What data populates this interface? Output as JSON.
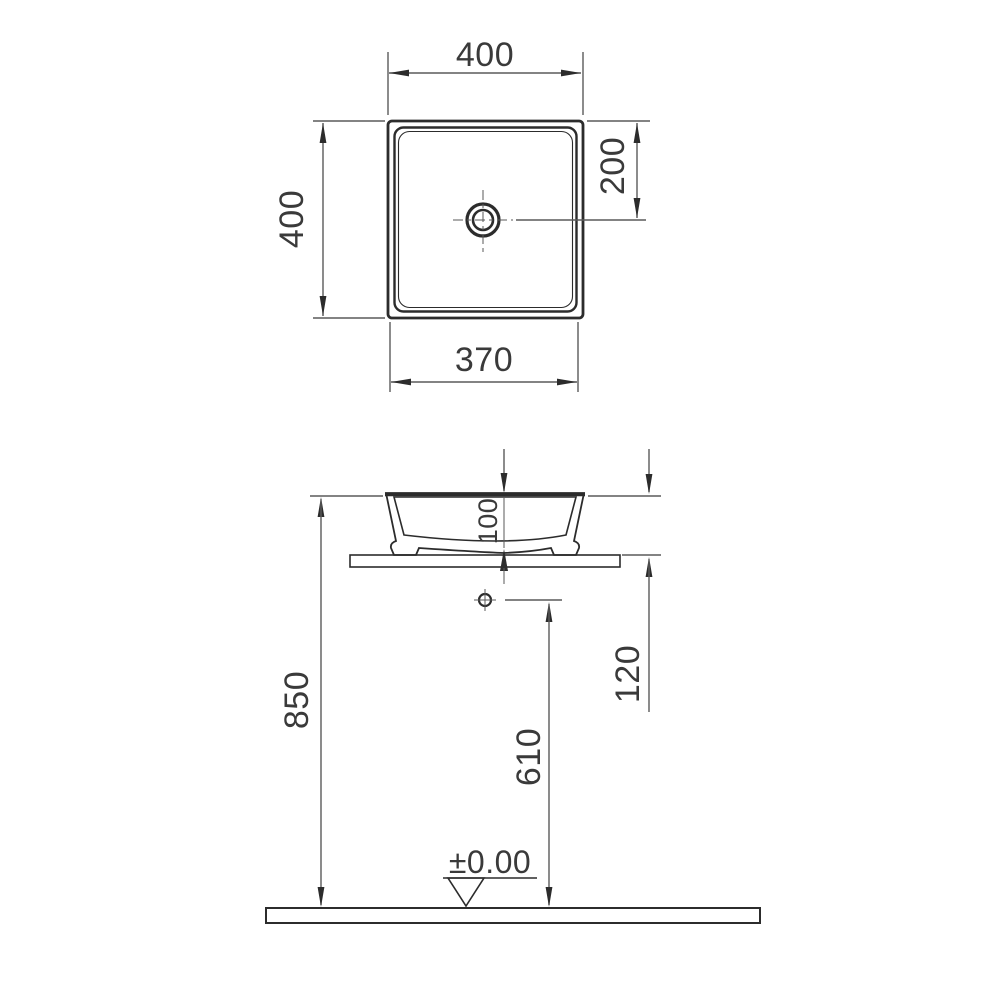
{
  "drawing_title": "square countertop washbasin technical drawing",
  "top_view": {
    "width_label": "400",
    "height_label": "400",
    "drain_offset_label": "200",
    "inner_width_label": "370"
  },
  "side_view": {
    "basin_height_label": "100",
    "rim_height_label": "850",
    "hole_offset_label": "120",
    "outlet_height_label": "610",
    "floor_level_label": "±0.00"
  },
  "colors": {
    "dimension_line": "#5a5a5a",
    "object_line": "#2c2c2c",
    "text": "#3a3a3a",
    "background": "#ffffff"
  }
}
